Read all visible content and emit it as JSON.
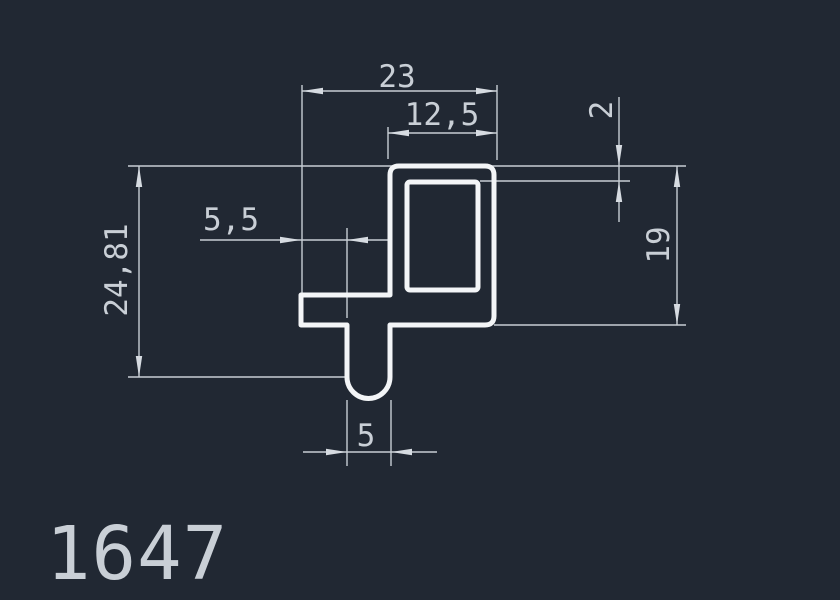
{
  "drawing_number": "1647",
  "colors": {
    "background": "#212833",
    "profile_line": "#f3f5f7",
    "dimension_line": "#c7cdd4",
    "text": "#c9cfd6"
  },
  "profile": {
    "description": "Extrusion profile cross-section: rectangular hollow flag with left arm and rounded-bottom stem",
    "hole": "rectangular"
  },
  "dimensions": {
    "total_width": {
      "label": "23",
      "value": 23,
      "orientation": "horizontal"
    },
    "flag_width": {
      "label": "12,5",
      "value": 12.5,
      "orientation": "horizontal"
    },
    "arm_length": {
      "label": "5,5",
      "value": 5.5,
      "orientation": "horizontal"
    },
    "wall_thickness": {
      "label": "2",
      "value": 2,
      "orientation": "vertical"
    },
    "flag_height": {
      "label": "19",
      "value": 19,
      "orientation": "vertical"
    },
    "total_height": {
      "label": "24,81",
      "value": 24.81,
      "orientation": "vertical"
    },
    "stem_width": {
      "label": "5",
      "value": 5,
      "orientation": "horizontal"
    }
  }
}
